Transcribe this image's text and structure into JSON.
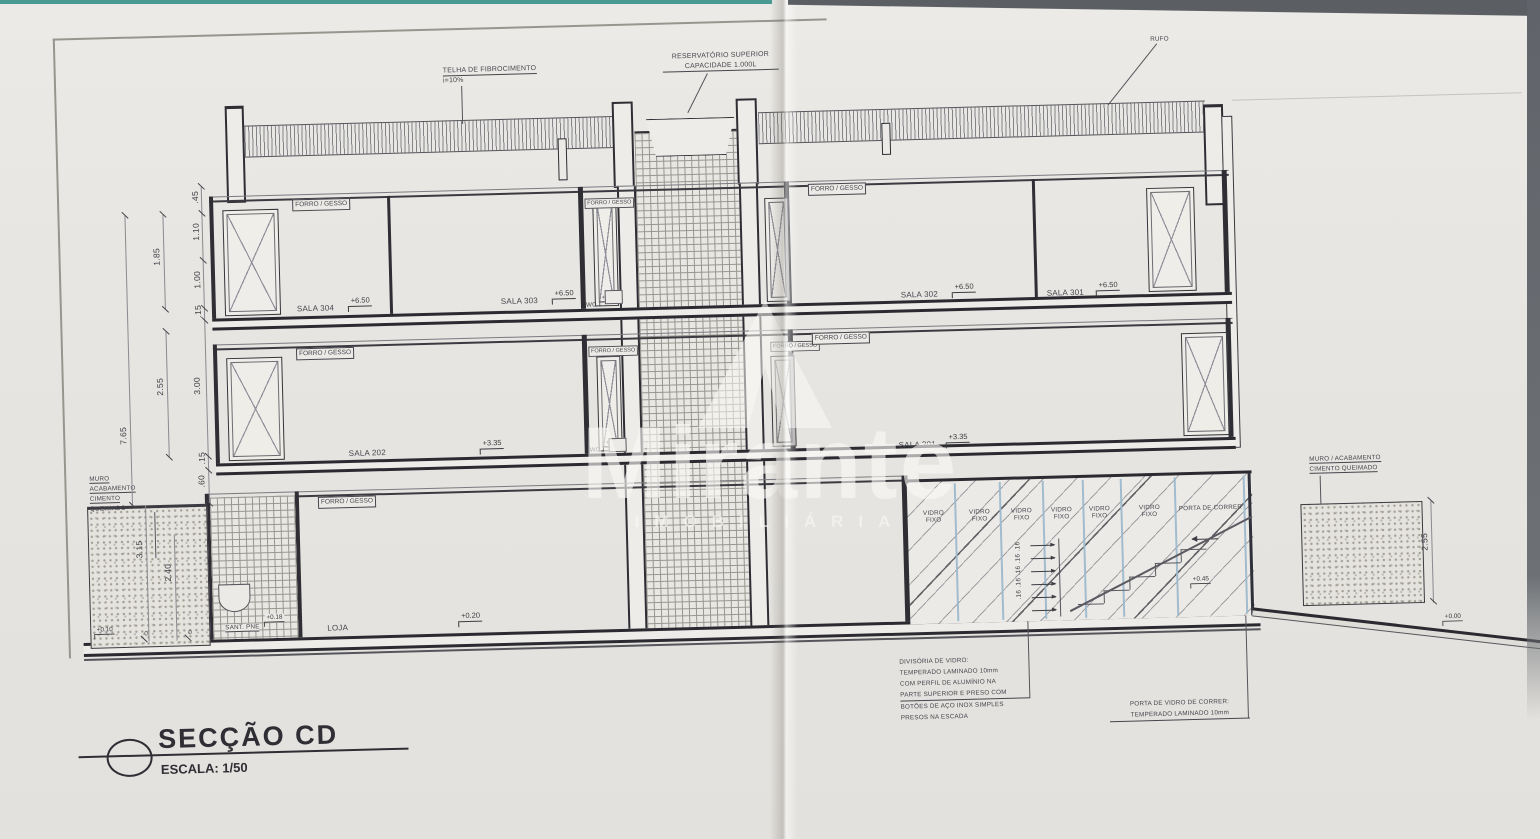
{
  "sheet": {
    "title": "SECÇÃO CD",
    "scale": "ESCALA: 1/50"
  },
  "watermark": {
    "brand": "Mirante",
    "subtitle": "IMOBILIÁRIA"
  },
  "roof": {
    "tile": "TELHA DE FIBROCIMENTO",
    "slope": "i=10%",
    "reservoir1": "RESERVATÓRIO SUPERIOR",
    "reservoir2": "CAPACIDADE 1.000L",
    "rufo": "RUFO"
  },
  "labels": {
    "forro": "FORRO / GESSO",
    "wc": "WC",
    "sant": "SANT. PNE",
    "loja": "LOJA",
    "vidro": "VIDRO",
    "fixo": "FIXO",
    "porta_correr": "PORTA DE CORRER"
  },
  "rooms": {
    "sala304": "SALA 304",
    "sala303": "SALA 303",
    "sala302": "SALA 302",
    "sala301": "SALA 301",
    "sala202": "SALA 202",
    "sala201": "SALA 201"
  },
  "levels": {
    "l650": "+6.50",
    "l645": "+6.45",
    "l335": "+3.35",
    "l330": "+3.30",
    "l020": "+0.20",
    "l018": "+0.18",
    "l010": "+0.10",
    "l045": "+0.45",
    "l000": "+0.00",
    "zero": "0"
  },
  "dims": {
    "d045": ".45",
    "d110": "1.10",
    "d100": "1.00",
    "d015": ".15",
    "d185": "1.85",
    "d255": "2.55",
    "d300": "3.00",
    "d765": "7.65",
    "d060": ".60",
    "d315": "3.15",
    "d240": "2.40",
    "risers": ".16 .16 .16 .16 .16"
  },
  "muro_left": {
    "l1": "MURO",
    "l2": "ACABAMENTO",
    "l3": "CIMENTO",
    "l4": "QUEIMADO"
  },
  "muro_right": {
    "l1": "MURO / ACABAMENTO",
    "l2": "CIMENTO QUEIMADO"
  },
  "notes": {
    "divisoria": {
      "l1": "DIVISÓRIA DE VIDRO:",
      "l2": "TEMPERADO LAMINADO 10mm",
      "l3": "COM PERFIL DE ALUMÍNIO NA",
      "l4": "PARTE SUPERIOR E PRESO COM",
      "l5": "BOTÕES DE AÇO INOX SIMPLES",
      "l6": "PRESOS NA ESCADA"
    },
    "porta": {
      "l1": "PORTA DE VIDRO DE CORRER:",
      "l2": "TEMPERADO LAMINADO 10mm"
    }
  },
  "colors": {
    "paper": "#e7e5e1",
    "ink": "#3b3b42",
    "glass_blue": "#9db9cc",
    "teal_edge": "#2c8c84"
  }
}
